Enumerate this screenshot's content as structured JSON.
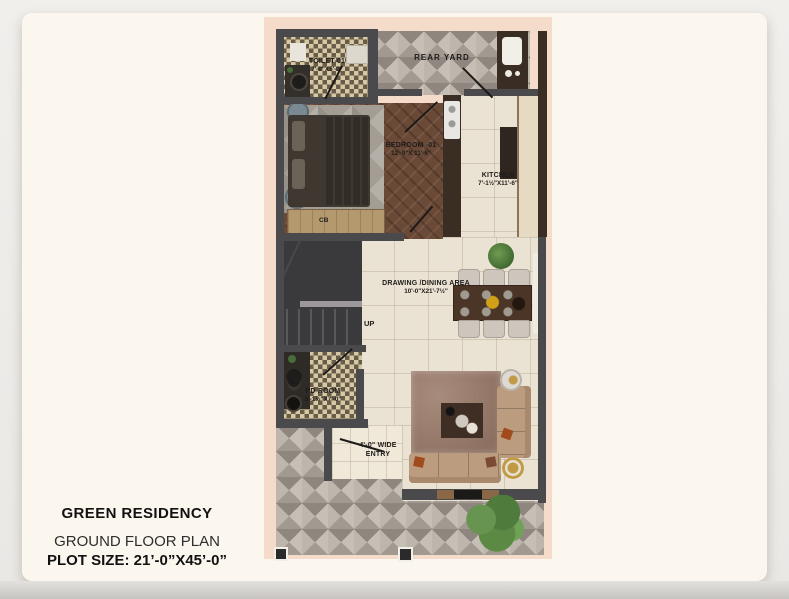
{
  "page": {
    "title": "GREEN RESIDENCY",
    "subtitle": "GROUND FLOOR PLAN",
    "plot_size": "PLOT SIZE: 21’-0”X45’-0”"
  },
  "plan": {
    "rooms": {
      "toilet": {
        "name": "TOILET-01",
        "dims": "7'-0\"X5'-0\""
      },
      "rear_yard": {
        "name": "REAR YARD"
      },
      "bedroom": {
        "name": "BEDROOM -01",
        "dims": "12'-9\"X 11'-6\""
      },
      "kitchen": {
        "name": "KITCHEN",
        "dims": "7'-1½\"X11'-6\""
      },
      "drawing_dining": {
        "name": "DRAWING /DINING AREA",
        "dims": "10'-0\"X21'-7½\""
      },
      "pd_room": {
        "name": "PD ROOM",
        "dims": "5'-1½\"X7'-0\""
      },
      "entry": {
        "line1": "4'-0\" WIDE",
        "line2": "ENTRY"
      },
      "stairs": {
        "label": "UP"
      },
      "wardrobe": {
        "label": "CB"
      }
    },
    "colors": {
      "sheet": "#fbf6ee",
      "site_border": "#f5dcca",
      "wall": "#4a4a4c",
      "wood_wall": "#3a2d23",
      "floor_beige": "#eae2d2",
      "floor_wood": "#6a4936",
      "tile_grey": "#aba39b",
      "tile_checker_dark": "#675c49",
      "tile_checker_light": "#d7c8a4",
      "sofa": "#bb9c7e",
      "rug_living": "#97796a",
      "rug_bedroom": "#a39d94",
      "table_wood": "#4a3526",
      "plant": "#5a8a45"
    }
  }
}
